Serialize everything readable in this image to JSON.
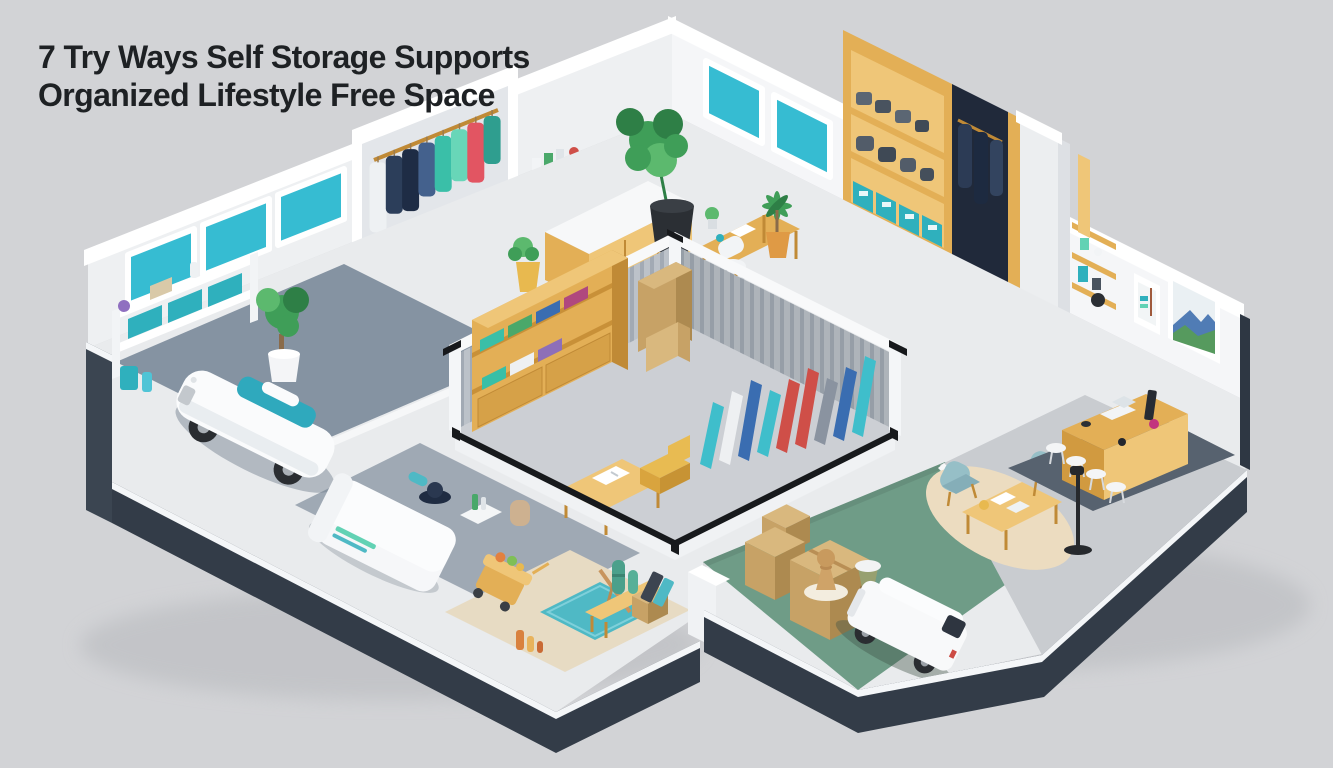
{
  "title": {
    "line1": "7 Try Ways Self Storage Supports",
    "line2": "Organized Lifestyle Free Space"
  },
  "palette": {
    "bg": "#d2d3d6",
    "titleColor": "#1e2124",
    "wallFaceL": "#eef0f2",
    "wallFaceR": "#f5f6f8",
    "beam": "#ffffff",
    "rim": "#f4f6f8",
    "wallDark": "#333c48",
    "wallDarkCap": "#3b4551",
    "wallEdge": "#2e3743",
    "floorWhite": "#e9ebed",
    "floorGarage": "#8593a2",
    "floorBedroom": "#9fa9b4",
    "floorBeige": "#e7dbc3",
    "floorGreen": "#6f9c87",
    "floorLight": "#c9ccd0",
    "rugOffice": "#57626f",
    "rugRound": "#ecdcc0",
    "rugTeal": "#4fb9c5",
    "unitWall": "#bcc2c9",
    "unitWallStripe": "#a2aab4",
    "unitFloor": "#cccfd4",
    "rail": "#17191c",
    "wood": "#e3af56",
    "woodDark": "#c08a36",
    "woodLight": "#efc678",
    "teal": "#2fb0bd",
    "windowTeal": "#36bcd2",
    "plant": "#3f9e58",
    "plantDark": "#2e7f46",
    "plantLight": "#5cb96e",
    "potBlack": "#2b2f34",
    "potOrange": "#df9a45",
    "cardboard": "#c7a266",
    "cardboardShade": "#ad8a50",
    "cardboardLight": "#d9b87e",
    "bedWhite": "#f6f7f9",
    "vanWhite": "#f8f9fa",
    "lampBlack": "#26292d",
    "stoolWhite": "#f4f5f6",
    "chairTeal": "#96bfc7",
    "carBody": "#fafbfc",
    "carGlass": "#2fa9bd",
    "accentRed": "#cf4f48",
    "accentBlue": "#3a6db1",
    "accentMint": "#62d2b4"
  },
  "scene": {
    "description": "Isometric cutaway home with central self-storage unit",
    "rooms": [
      {
        "name": "garage",
        "objects": [
          "white-sports-car",
          "wall-shelf-teal-bins",
          "potted-tree",
          "teal-windows"
        ]
      },
      {
        "name": "walk-in-closet",
        "objects": [
          "closet-frame",
          "hanging-garments"
        ]
      },
      {
        "name": "study",
        "objects": [
          "monstera-plant",
          "wood-desk",
          "white-chair",
          "book-shelf",
          "credenza",
          "palm-plant",
          "teal-windows"
        ]
      },
      {
        "name": "wardrobe-room",
        "objects": [
          "open-wardrobe",
          "folded-gray-bags",
          "teal-bins",
          "hanging-suits"
        ]
      },
      {
        "name": "central-storage-unit",
        "objects": [
          "corrugated-walls",
          "black-door-rails",
          "wood-shelving",
          "cardboard-boxes",
          "rolled-rugs",
          "work-table",
          "yellow-seat"
        ]
      },
      {
        "name": "bedroom",
        "objects": [
          "white-bed",
          "dark-hat",
          "perfume-tray"
        ]
      },
      {
        "name": "hobby-room",
        "objects": [
          "food-cart",
          "teal-rug",
          "wood-bench",
          "cacti",
          "storage-box",
          "bottles"
        ]
      },
      {
        "name": "moving-room",
        "objects": [
          "cardboard-boxes",
          "pawn-floor-lamp",
          "stool",
          "white-delivery-van"
        ]
      },
      {
        "name": "office",
        "objects": [
          "meeting-table",
          "teal-chairs",
          "round-rug",
          "desk-counter",
          "white-stools",
          "floor-lamp",
          "wall-art",
          "wall-shelves"
        ]
      }
    ],
    "closet": {
      "garment_colors": [
        "#eef1f3",
        "#2c3e5a",
        "#1e2c45",
        "#44618d",
        "#3abfa8",
        "#68d6b8",
        "#e25562",
        "#2f9e8f"
      ],
      "garment_heights": [
        70,
        58,
        62,
        54,
        56,
        52,
        60,
        48
      ]
    },
    "storage_unit": {
      "roll_colors": [
        "#3fbecb",
        "#eef0f2",
        "#3a6db1",
        "#3fbecb",
        "#cf4f48",
        "#cf4f48",
        "#8a93a0",
        "#3a6db1",
        "#3fbecb"
      ]
    }
  }
}
